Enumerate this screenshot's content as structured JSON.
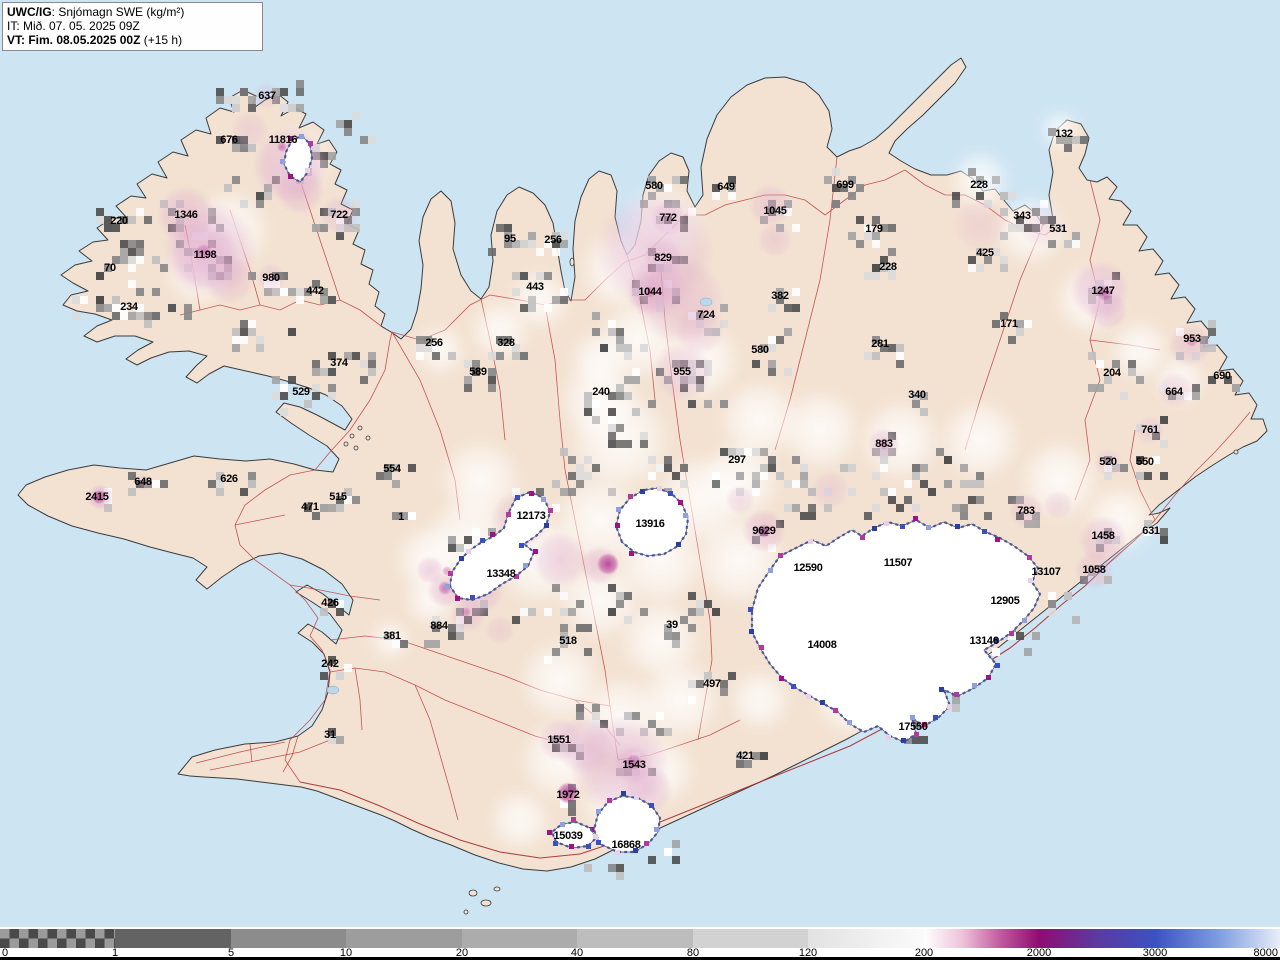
{
  "header": {
    "product_code": "UWC/IG",
    "product_rest": ": Snjómagn SWE (kg/m²)",
    "init_time": "IT: Mið. 07. 05. 2025 09Z",
    "valid_time_bold": "VT: Fim. 08.05.2025 00Z",
    "valid_time_rest": " (+15 h)"
  },
  "colorbar": {
    "ticks": [
      "0",
      "1",
      "5",
      "10",
      "20",
      "40",
      "80",
      "120",
      "200",
      "2000",
      "3000",
      "8000"
    ],
    "segments": [
      {
        "type": "checker",
        "c1": "#4a4a4a",
        "c2": "#9b9b9b"
      },
      {
        "type": "solid",
        "color": "#636363"
      },
      {
        "type": "solid",
        "color": "#8c8c8c"
      },
      {
        "type": "solid",
        "color": "#9d9d9d"
      },
      {
        "type": "solid",
        "color": "#acacac"
      },
      {
        "type": "solid",
        "color": "#bdbdbd"
      },
      {
        "type": "solid",
        "color": "#d2d2d2"
      },
      {
        "type": "gradient",
        "stops": [
          "#e2e2e2",
          "#fbfbfb"
        ]
      },
      {
        "type": "gradient",
        "stops": [
          "#ffffff",
          "#eec3da",
          "#c05a9e",
          "#8e0d72"
        ]
      },
      {
        "type": "gradient",
        "stops": [
          "#8e0d72",
          "#5c3aa0",
          "#3b52c1"
        ]
      },
      {
        "type": "gradient",
        "stops": [
          "#3b52c1",
          "#7d9be0",
          "#e8eef8"
        ]
      }
    ]
  },
  "map": {
    "colors": {
      "ocean": "#cde4f2",
      "land": "#f3e2d2",
      "coast": "#3c3c3c",
      "road": "#c04545",
      "road_main": "#a62c2c",
      "glacier": "#ffffff",
      "glacier_edge": "#4a5ec8",
      "pink": "#dea8cc",
      "magenta": "#b12a90",
      "lake": "#bcd6ea"
    },
    "labels": [
      {
        "v": "637",
        "x": 267,
        "y": 96
      },
      {
        "v": "676",
        "x": 229,
        "y": 140
      },
      {
        "v": "11816",
        "x": 283,
        "y": 140
      },
      {
        "v": "1346",
        "x": 186,
        "y": 215
      },
      {
        "v": "722",
        "x": 339,
        "y": 215
      },
      {
        "v": "220",
        "x": 119,
        "y": 221
      },
      {
        "v": "1198",
        "x": 205,
        "y": 255
      },
      {
        "v": "70",
        "x": 110,
        "y": 268
      },
      {
        "v": "980",
        "x": 271,
        "y": 278
      },
      {
        "v": "442",
        "x": 315,
        "y": 291
      },
      {
        "v": "234",
        "x": 129,
        "y": 307
      },
      {
        "v": "374",
        "x": 339,
        "y": 363
      },
      {
        "v": "529",
        "x": 301,
        "y": 392
      },
      {
        "v": "95",
        "x": 510,
        "y": 239
      },
      {
        "v": "256",
        "x": 553,
        "y": 240
      },
      {
        "v": "443",
        "x": 535,
        "y": 287
      },
      {
        "v": "256",
        "x": 434,
        "y": 343
      },
      {
        "v": "328",
        "x": 506,
        "y": 343
      },
      {
        "v": "589",
        "x": 478,
        "y": 372
      },
      {
        "v": "240",
        "x": 601,
        "y": 392
      },
      {
        "v": "580",
        "x": 654,
        "y": 186
      },
      {
        "v": "772",
        "x": 668,
        "y": 218
      },
      {
        "v": "829",
        "x": 663,
        "y": 258
      },
      {
        "v": "1044",
        "x": 650,
        "y": 292
      },
      {
        "v": "724",
        "x": 706,
        "y": 315
      },
      {
        "v": "955",
        "x": 682,
        "y": 372
      },
      {
        "v": "649",
        "x": 726,
        "y": 187
      },
      {
        "v": "1045",
        "x": 775,
        "y": 211
      },
      {
        "v": "699",
        "x": 845,
        "y": 185
      },
      {
        "v": "179",
        "x": 874,
        "y": 229
      },
      {
        "v": "228",
        "x": 888,
        "y": 267
      },
      {
        "v": "382",
        "x": 780,
        "y": 296
      },
      {
        "v": "580",
        "x": 760,
        "y": 350
      },
      {
        "v": "281",
        "x": 880,
        "y": 344
      },
      {
        "v": "340",
        "x": 917,
        "y": 395
      },
      {
        "v": "228",
        "x": 979,
        "y": 185
      },
      {
        "v": "343",
        "x": 1022,
        "y": 216
      },
      {
        "v": "531",
        "x": 1058,
        "y": 229
      },
      {
        "v": "425",
        "x": 985,
        "y": 253
      },
      {
        "v": "171",
        "x": 1009,
        "y": 324
      },
      {
        "v": "132",
        "x": 1064,
        "y": 134
      },
      {
        "v": "1247",
        "x": 1103,
        "y": 291
      },
      {
        "v": "953",
        "x": 1192,
        "y": 339
      },
      {
        "v": "204",
        "x": 1112,
        "y": 373
      },
      {
        "v": "690",
        "x": 1222,
        "y": 376
      },
      {
        "v": "664",
        "x": 1174,
        "y": 392
      },
      {
        "v": "761",
        "x": 1150,
        "y": 430
      },
      {
        "v": "520",
        "x": 1108,
        "y": 462
      },
      {
        "v": "550",
        "x": 1145,
        "y": 462
      },
      {
        "v": "783",
        "x": 1026,
        "y": 511
      },
      {
        "v": "631",
        "x": 1151,
        "y": 531
      },
      {
        "v": "1458",
        "x": 1103,
        "y": 536
      },
      {
        "v": "1058",
        "x": 1094,
        "y": 570
      },
      {
        "v": "13107",
        "x": 1046,
        "y": 572
      },
      {
        "v": "12905",
        "x": 1005,
        "y": 601
      },
      {
        "v": "13146",
        "x": 984,
        "y": 641
      },
      {
        "v": "297",
        "x": 737,
        "y": 460
      },
      {
        "v": "883",
        "x": 884,
        "y": 444
      },
      {
        "v": "9629",
        "x": 764,
        "y": 531
      },
      {
        "v": "12590",
        "x": 808,
        "y": 568
      },
      {
        "v": "11507",
        "x": 898,
        "y": 563
      },
      {
        "v": "14008",
        "x": 822,
        "y": 645
      },
      {
        "v": "17550",
        "x": 913,
        "y": 727
      },
      {
        "v": "13916",
        "x": 650,
        "y": 524
      },
      {
        "v": "12173",
        "x": 531,
        "y": 516
      },
      {
        "v": "13348",
        "x": 501,
        "y": 574
      },
      {
        "v": "884",
        "x": 439,
        "y": 626
      },
      {
        "v": "518",
        "x": 568,
        "y": 641
      },
      {
        "v": "39",
        "x": 672,
        "y": 625
      },
      {
        "v": "1",
        "x": 401,
        "y": 517
      },
      {
        "v": "554",
        "x": 392,
        "y": 469
      },
      {
        "v": "515",
        "x": 338,
        "y": 497
      },
      {
        "v": "471",
        "x": 310,
        "y": 507
      },
      {
        "v": "626",
        "x": 229,
        "y": 479
      },
      {
        "v": "648",
        "x": 143,
        "y": 482
      },
      {
        "v": "2415",
        "x": 97,
        "y": 497
      },
      {
        "v": "426",
        "x": 330,
        "y": 603
      },
      {
        "v": "381",
        "x": 392,
        "y": 636
      },
      {
        "v": "242",
        "x": 330,
        "y": 664
      },
      {
        "v": "31",
        "x": 330,
        "y": 735
      },
      {
        "v": "497",
        "x": 712,
        "y": 684
      },
      {
        "v": "421",
        "x": 745,
        "y": 756
      },
      {
        "v": "1551",
        "x": 559,
        "y": 740
      },
      {
        "v": "1543",
        "x": 634,
        "y": 765
      },
      {
        "v": "1972",
        "x": 568,
        "y": 795
      },
      {
        "v": "15039",
        "x": 568,
        "y": 836
      },
      {
        "v": "16868",
        "x": 626,
        "y": 845
      }
    ]
  }
}
